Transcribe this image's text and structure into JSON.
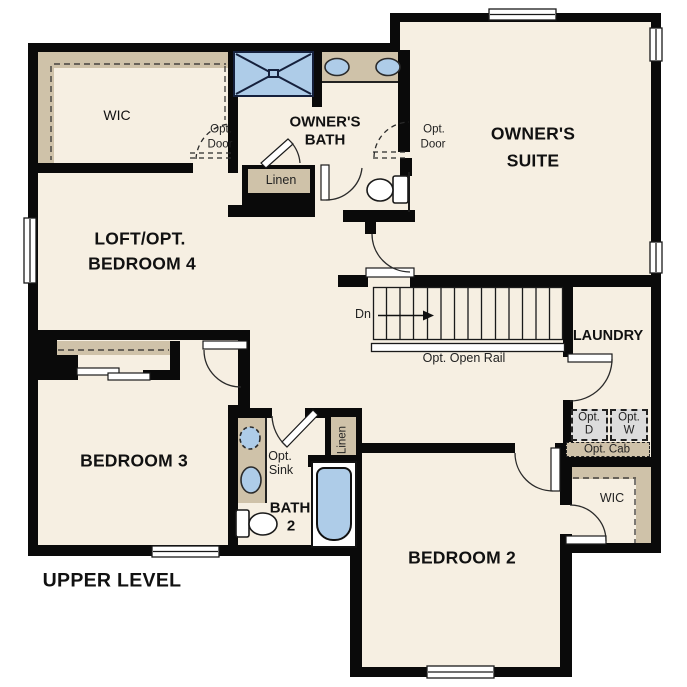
{
  "plan": {
    "title": "UPPER LEVEL",
    "rooms": {
      "loft": {
        "line1": "LOFT/OPT.",
        "line2": "BEDROOM 4"
      },
      "owners_suite": {
        "line1": "OWNER'S",
        "line2": "SUITE"
      },
      "owners_bath": {
        "line1": "OWNER'S",
        "line2": "BATH"
      },
      "bedroom2": {
        "label": "BEDROOM 2"
      },
      "bedroom3": {
        "label": "BEDROOM 3"
      },
      "bath2": {
        "line1": "BATH",
        "line2": "2"
      },
      "laundry": {
        "label": "LAUNDRY"
      },
      "wic_owners": {
        "label": "WIC"
      },
      "wic_bedroom2": {
        "label": "WIC"
      }
    },
    "annotations": {
      "opt_door_wic": {
        "line1": "Opt.",
        "line2": "Door"
      },
      "opt_door_suite": {
        "line1": "Opt.",
        "line2": "Door"
      },
      "linen_hall": {
        "label": "Linen"
      },
      "linen_bath2": {
        "label": "Linen"
      },
      "stairs_down": {
        "label": "Dn"
      },
      "opt_open_rail": {
        "label": "Opt. Open Rail"
      },
      "opt_dryer": {
        "line1": "Opt.",
        "line2": "D"
      },
      "opt_washer": {
        "line1": "Opt.",
        "line2": "W"
      },
      "opt_cabinet": {
        "label": "Opt. Cab"
      },
      "opt_sink": {
        "line1": "Opt.",
        "line2": "Sink"
      }
    },
    "colors": {
      "floor": "#f6efe2",
      "cabinet_tan": "#cfc2a9",
      "fixture_blue": "#aecce8",
      "appliance_gray": "#dcdcdc",
      "wall": "#0a0a0a",
      "background": "#ffffff"
    }
  }
}
